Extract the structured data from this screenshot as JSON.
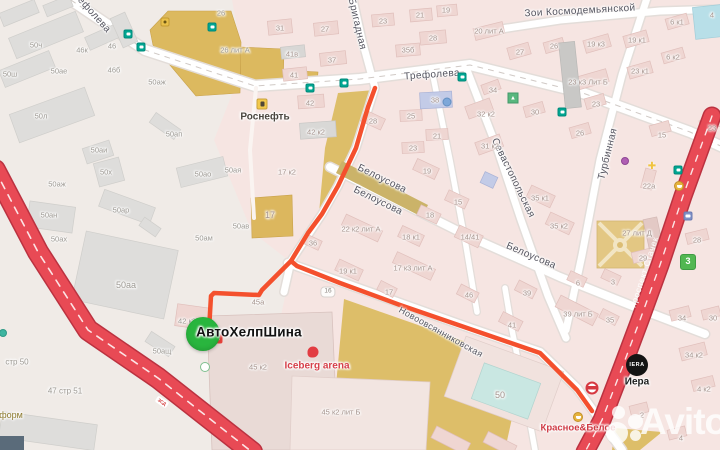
{
  "app": {
    "type": "map-route-view"
  },
  "watermark": {
    "brand": "Avito"
  },
  "colors": {
    "route": "#f4502d",
    "highway": "#e84a55",
    "marker": "#29b53e",
    "street_fill": "#ffffff",
    "landuse_tan": "#ddbe69",
    "block_pink": "#f6e5e2"
  },
  "destination": {
    "name": "АвтоХелпШина",
    "x": 249,
    "y": 332,
    "marker_x": 203,
    "marker_y": 334
  },
  "street_labels": [
    {
      "t": "Трефолева",
      "x": 432,
      "y": 75,
      "r": -4
    },
    {
      "t": "ефолева",
      "x": 94,
      "y": 15,
      "r": 48
    },
    {
      "t": "Бригадная",
      "x": 357,
      "y": 24,
      "r": 77
    },
    {
      "t": "Зои Космодемьянской",
      "x": 580,
      "y": 11,
      "r": -3
    },
    {
      "t": "Севастопольская",
      "x": 513,
      "y": 178,
      "r": 64
    },
    {
      "t": "Белоусова",
      "x": 382,
      "y": 179,
      "r": 26
    },
    {
      "t": "Белоусова",
      "x": 378,
      "y": 201,
      "r": 26
    },
    {
      "t": "Белоусова",
      "x": 531,
      "y": 256,
      "r": 23
    },
    {
      "t": "Турбинная",
      "x": 608,
      "y": 154,
      "r": -76
    },
    {
      "t": "Новоовсянниковская",
      "x": 441,
      "y": 332,
      "r": 29,
      "cls": "small"
    },
    {
      "t": "проспект Стачек",
      "x": 644,
      "y": 272,
      "r": -72,
      "cls": "on-road"
    }
  ],
  "building_labels": [
    {
      "t": "50ч",
      "x": 36,
      "y": 45,
      "c": "ind"
    },
    {
      "t": "46к",
      "x": 82,
      "y": 50,
      "c": "ind"
    },
    {
      "t": "46",
      "x": 112,
      "y": 46,
      "c": "ind"
    },
    {
      "t": "50ш",
      "x": 10,
      "y": 74,
      "c": "ind"
    },
    {
      "t": "50ае",
      "x": 59,
      "y": 71,
      "c": "ind"
    },
    {
      "t": "46б",
      "x": 114,
      "y": 70,
      "c": "ind"
    },
    {
      "t": "50аж",
      "x": 157,
      "y": 82,
      "c": "ind"
    },
    {
      "t": "50л",
      "x": 41,
      "y": 116,
      "c": "ind"
    },
    {
      "t": "50ап",
      "x": 174,
      "y": 134,
      "c": "ind"
    },
    {
      "t": "26",
      "x": 221,
      "y": 13,
      "c": "ind"
    },
    {
      "t": "26 лит А",
      "x": 235,
      "y": 50,
      "c": "ind"
    },
    {
      "t": "50аи",
      "x": 99,
      "y": 150,
      "c": "ind"
    },
    {
      "t": "50х",
      "x": 106,
      "y": 172,
      "c": "ind"
    },
    {
      "t": "50аж",
      "x": 57,
      "y": 184,
      "c": "ind"
    },
    {
      "t": "50ая",
      "x": 233,
      "y": 170,
      "c": "ind"
    },
    {
      "t": "50ао",
      "x": 203,
      "y": 174,
      "c": "ind"
    },
    {
      "t": "50ар",
      "x": 121,
      "y": 210,
      "c": "ind"
    },
    {
      "t": "50ан",
      "x": 49,
      "y": 215,
      "c": "ind"
    },
    {
      "t": "50ах",
      "x": 59,
      "y": 239,
      "c": "ind"
    },
    {
      "t": "50ам",
      "x": 204,
      "y": 238,
      "c": "ind"
    },
    {
      "t": "50ав",
      "x": 241,
      "y": 226,
      "c": "ind"
    },
    {
      "t": "50аа",
      "x": 126,
      "y": 285,
      "c": "ind big"
    },
    {
      "t": "50ащ",
      "x": 162,
      "y": 351,
      "c": "ind"
    },
    {
      "t": "42 к3",
      "x": 187,
      "y": 321,
      "c": "ind"
    },
    {
      "t": "31",
      "x": 280,
      "y": 28
    },
    {
      "t": "27",
      "x": 325,
      "y": 29
    },
    {
      "t": "37",
      "x": 332,
      "y": 60
    },
    {
      "t": "41в",
      "x": 292,
      "y": 54
    },
    {
      "t": "41",
      "x": 294,
      "y": 75
    },
    {
      "t": "42",
      "x": 310,
      "y": 103
    },
    {
      "t": "42 к2",
      "x": 316,
      "y": 132
    },
    {
      "t": "17 к2",
      "x": 287,
      "y": 172
    },
    {
      "t": "17",
      "x": 270,
      "y": 215,
      "c": "big"
    },
    {
      "t": "23",
      "x": 383,
      "y": 21
    },
    {
      "t": "21",
      "x": 420,
      "y": 15
    },
    {
      "t": "19",
      "x": 446,
      "y": 10
    },
    {
      "t": "28",
      "x": 433,
      "y": 38
    },
    {
      "t": "35б",
      "x": 408,
      "y": 50
    },
    {
      "t": "38",
      "x": 435,
      "y": 100
    },
    {
      "t": "25",
      "x": 411,
      "y": 116
    },
    {
      "t": "21",
      "x": 437,
      "y": 136
    },
    {
      "t": "23",
      "x": 413,
      "y": 148
    },
    {
      "t": "19",
      "x": 427,
      "y": 171
    },
    {
      "t": "28",
      "x": 373,
      "y": 121
    },
    {
      "t": "15",
      "x": 458,
      "y": 202
    },
    {
      "t": "18",
      "x": 430,
      "y": 215
    },
    {
      "t": "18 к1",
      "x": 411,
      "y": 237
    },
    {
      "t": "14/41",
      "x": 470,
      "y": 237
    },
    {
      "t": "22 к2 лит А",
      "x": 361,
      "y": 229
    },
    {
      "t": "17 к3 лит А",
      "x": 413,
      "y": 268
    },
    {
      "t": "19 к1",
      "x": 348,
      "y": 271
    },
    {
      "t": "36",
      "x": 313,
      "y": 243
    },
    {
      "t": "17",
      "x": 389,
      "y": 292
    },
    {
      "t": "46",
      "x": 469,
      "y": 295
    },
    {
      "t": "45а",
      "x": 258,
      "y": 302
    },
    {
      "t": "45 к2",
      "x": 258,
      "y": 367
    },
    {
      "t": "45 к2 лит Б",
      "x": 341,
      "y": 412
    },
    {
      "t": "39",
      "x": 527,
      "y": 293
    },
    {
      "t": "39 лит Б",
      "x": 578,
      "y": 314
    },
    {
      "t": "41",
      "x": 512,
      "y": 325
    },
    {
      "t": "35",
      "x": 610,
      "y": 320
    },
    {
      "t": "50",
      "x": 500,
      "y": 395,
      "c": "big"
    },
    {
      "t": "20 лит А",
      "x": 489,
      "y": 31
    },
    {
      "t": "27",
      "x": 520,
      "y": 52
    },
    {
      "t": "26",
      "x": 554,
      "y": 46
    },
    {
      "t": "19 к3",
      "x": 596,
      "y": 44
    },
    {
      "t": "19 к1",
      "x": 637,
      "y": 40
    },
    {
      "t": "4",
      "x": 712,
      "y": 15
    },
    {
      "t": "6 к1",
      "x": 677,
      "y": 22
    },
    {
      "t": "6 к2",
      "x": 673,
      "y": 57
    },
    {
      "t": "23 к1",
      "x": 640,
      "y": 71
    },
    {
      "t": "23 к3 Лит Б",
      "x": 588,
      "y": 82
    },
    {
      "t": "34",
      "x": 493,
      "y": 90
    },
    {
      "t": "32 к2",
      "x": 486,
      "y": 114
    },
    {
      "t": "31 к2",
      "x": 490,
      "y": 146
    },
    {
      "t": "30",
      "x": 535,
      "y": 112
    },
    {
      "t": "23",
      "x": 596,
      "y": 104
    },
    {
      "t": "26",
      "x": 580,
      "y": 133
    },
    {
      "t": "15",
      "x": 662,
      "y": 135
    },
    {
      "t": "23",
      "x": 712,
      "y": 128
    },
    {
      "t": "35 к1",
      "x": 540,
      "y": 198
    },
    {
      "t": "35 к2",
      "x": 559,
      "y": 226
    },
    {
      "t": "22а",
      "x": 649,
      "y": 186
    },
    {
      "t": "27 лит Д",
      "x": 637,
      "y": 233
    },
    {
      "t": "29",
      "x": 643,
      "y": 258
    },
    {
      "t": "28",
      "x": 697,
      "y": 240
    },
    {
      "t": "6",
      "x": 578,
      "y": 283
    },
    {
      "t": "3",
      "x": 613,
      "y": 282
    },
    {
      "t": "34",
      "x": 682,
      "y": 318
    },
    {
      "t": "30",
      "x": 713,
      "y": 318
    },
    {
      "t": "34 к2",
      "x": 694,
      "y": 355
    },
    {
      "t": "4 к2",
      "x": 704,
      "y": 389
    },
    {
      "t": "2",
      "x": 642,
      "y": 415
    },
    {
      "t": "4",
      "x": 681,
      "y": 438
    }
  ],
  "area_labels": [
    {
      "t": "стр 50",
      "x": 17,
      "y": 362
    },
    {
      "t": "47 стр 51",
      "x": 65,
      "y": 391
    }
  ],
  "pois": [
    {
      "id": "rosneft",
      "t": "Роснефть",
      "x": 265,
      "y": 117,
      "cls": "dark"
    },
    {
      "id": "avtohelpshina",
      "t": "АвтоХелпШина",
      "x": 249,
      "y": 332,
      "cls": "main"
    },
    {
      "id": "iceberg-arena",
      "t": "Iceberg arena",
      "x": 317,
      "y": 366,
      "cls": "red"
    },
    {
      "id": "krasnoe-beloe",
      "t": "Красное&Белое",
      "x": 578,
      "y": 428,
      "cls": "red2"
    },
    {
      "id": "iera",
      "t": "Иера",
      "x": 637,
      "y": 382,
      "cls": "black"
    },
    {
      "id": "form",
      "t": "форм",
      "x": 11,
      "y": 415,
      "cls": "olive"
    }
  ],
  "logo_texts": {
    "iera_circle": "IERA"
  },
  "badges": [
    {
      "t": "3",
      "x": 688,
      "y": 262,
      "cls": "b3",
      "name": "transit-route-badge"
    },
    {
      "t": "16",
      "x": 328,
      "y": 292,
      "cls": "b16",
      "name": "house-number-plate"
    },
    {
      "t": "ЗСД",
      "x": 162,
      "y": 402,
      "cls": "zsd",
      "r": 33,
      "name": "toll-road-badge"
    }
  ],
  "icons": [
    {
      "type": "transit",
      "x": 128,
      "y": 34
    },
    {
      "type": "transit",
      "x": 141,
      "y": 47
    },
    {
      "type": "transit",
      "x": 212,
      "y": 27
    },
    {
      "type": "transit",
      "x": 310,
      "y": 88
    },
    {
      "type": "transit",
      "x": 344,
      "y": 83
    },
    {
      "type": "transit",
      "x": 462,
      "y": 77
    },
    {
      "type": "transit",
      "x": 562,
      "y": 112
    },
    {
      "type": "transit",
      "x": 678,
      "y": 170
    },
    {
      "type": "shopY",
      "x": 165,
      "y": 22
    },
    {
      "type": "fuel",
      "x": 262,
      "y": 104
    },
    {
      "type": "cart",
      "x": 679,
      "y": 186
    },
    {
      "type": "cart",
      "x": 578,
      "y": 417
    },
    {
      "type": "bus",
      "x": 688,
      "y": 216
    },
    {
      "type": "cross",
      "x": 652,
      "y": 167,
      "glyph": "✚"
    },
    {
      "type": "purple dot",
      "x": 625,
      "y": 161
    },
    {
      "type": "park",
      "x": 513,
      "y": 98,
      "glyph": "▲"
    },
    {
      "type": "blue dot",
      "x": 447,
      "y": 102
    },
    {
      "type": "teal dot",
      "x": 3,
      "y": 333
    },
    {
      "type": "ring",
      "x": 205,
      "y": 367
    },
    {
      "type": "kb",
      "x": 592,
      "y": 388
    },
    {
      "type": "iceb",
      "x": 313,
      "y": 352
    },
    {
      "type": "shopRed",
      "x": 218,
      "y": 339
    }
  ]
}
